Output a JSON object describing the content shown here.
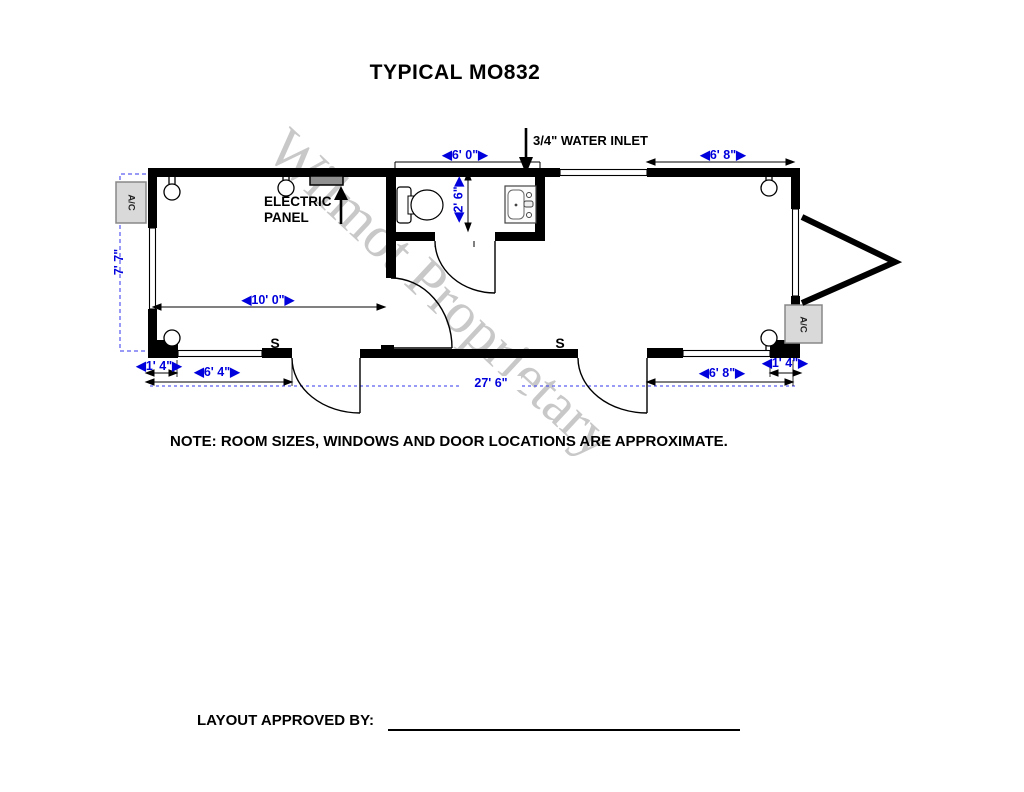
{
  "title": "TYPICAL MO832",
  "watermark": "Wilmot Proprietary",
  "plan": {
    "water_inlet_label": "3/4\" WATER INLET",
    "electric_panel_line1": "ELECTRIC",
    "electric_panel_line2": "PANEL",
    "ac_label_left": "A/C",
    "ac_label_right": "A/C",
    "switch_left": "S",
    "switch_right": "S"
  },
  "dimensions": {
    "bath_width": "◀6' 0\"▶",
    "top_right_span": "◀6' 8\"▶",
    "left_height": "7' 7\"",
    "bath_depth": "◀2' 6\"▶",
    "left_room_width": "◀10' 0\"▶",
    "bottom_left_offset": "◀1' 4\"▶",
    "bottom_left_span": "◀6' 4\"▶",
    "overall_length": "27' 6\"",
    "bottom_right_span": "◀6' 8\"▶",
    "bottom_right_offset": "◀1' 4\"▶"
  },
  "note": "NOTE:  ROOM SIZES, WINDOWS AND DOOR LOCATIONS ARE APPROXIMATE.",
  "approval_label": "LAYOUT APPROVED BY:",
  "colors": {
    "wall_black": "#000000",
    "dimension_blue": "#0000dd",
    "watermark_gray": "#c8c8c8",
    "ac_fill": "#d9d9d9",
    "panel_fill": "#909090"
  }
}
